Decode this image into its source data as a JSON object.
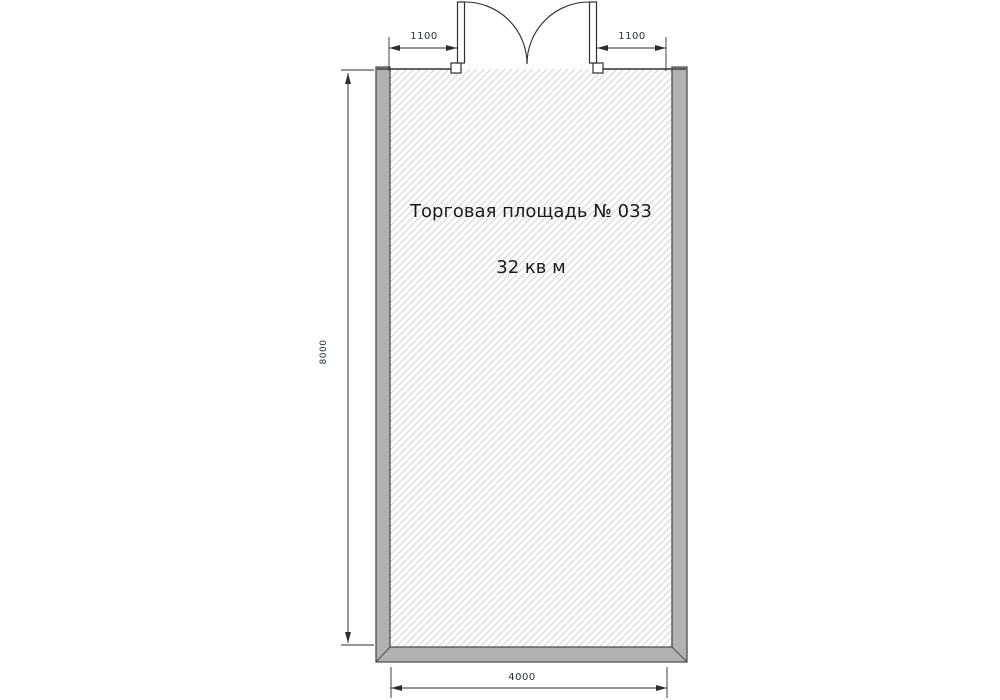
{
  "plan": {
    "room": {
      "name": "Торговая площадь № 033",
      "area": "32 кв м"
    },
    "dimensions": {
      "door_offset_left": "1100",
      "door_offset_right": "1100",
      "depth": "8000",
      "width": "4000"
    },
    "colors": {
      "wall_fill": "#b2b2b2",
      "wall_stroke": "#4d4d4d",
      "hatch_line": "#ccd8cc",
      "line_color": "#2e2e2e",
      "label_color": "#1a1a1a",
      "dim_text_color": "#26303b"
    }
  }
}
